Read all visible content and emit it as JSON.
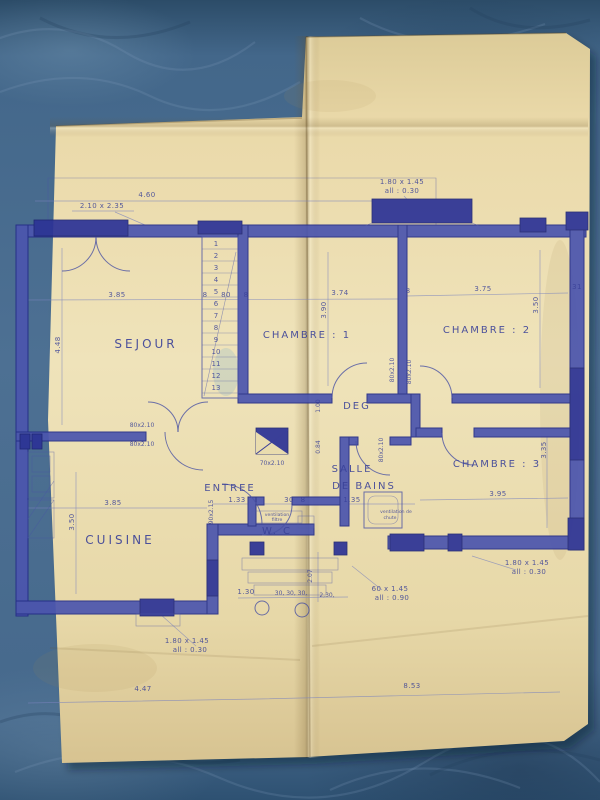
{
  "scene": {
    "description": "Photograph of a hand-drawn architectural floor plan (blueprint ink on cream folded paper) lying on a blue denim-like surface"
  },
  "colors": {
    "background": "#4d7093",
    "paper": "#ebdfb2",
    "ink": "#2c3596",
    "wall_fill": "#4c56ae",
    "window_fill": "#2d3396"
  },
  "rooms": {
    "sejour": "SEJOUR",
    "chambre1": "CHAMBRE : 1",
    "chambre2": "CHAMBRE : 2",
    "chambre3": "CHAMBRE : 3",
    "cuisine": "CUISINE",
    "entree": "ENTREE",
    "deg": "DEG",
    "salle": "SALLE",
    "de_bains": "DE  BAINS",
    "wc": "W. C"
  },
  "dims": {
    "bay_width": "4.60",
    "bay_size": "2.10 x 2.35",
    "sejour_w": "3.85",
    "sejour_h": "4.48",
    "chambre1_w": "3.74",
    "chambre1_h": "3.90",
    "chambre2_w": "3.75",
    "chambre2_h": "3.50",
    "chambre3_w": "3.95",
    "chambre3_h": "3.35",
    "cuisine_w": "3.85",
    "cuisine_h": "3.50",
    "entree_w": "1.33",
    "bains_w": "1.35",
    "deg_a": "1.00",
    "deg_b": "0.84",
    "porch_h": "2.07",
    "chain_a": "1.30",
    "chain_b": "30, 30, 30,",
    "chain_c": "2,30,",
    "total_left": "4.47",
    "total_right": "8.53",
    "wall_8": "8",
    "stair_80": "80",
    "wall_31": "31",
    "duct_30": "30"
  },
  "openings": {
    "window_large": "1.80 x 1.45",
    "sill_low": "all : 0.30",
    "window_small": "60 x 1.45",
    "sill_high": "all : 0.90",
    "door_80": "80x2.10",
    "door_70": "70x2.10",
    "door_90": "90x2.15"
  },
  "notes": {
    "vent_filter_line1": "ventilation",
    "vent_filter_line2": "filtre",
    "vent_chute_line1": "ventilation de",
    "vent_chute_line2": "chute"
  },
  "stairs": [
    "1",
    "2",
    "3",
    "4",
    "5",
    "6",
    "7",
    "8",
    "9",
    "10",
    "11",
    "12",
    "13"
  ]
}
